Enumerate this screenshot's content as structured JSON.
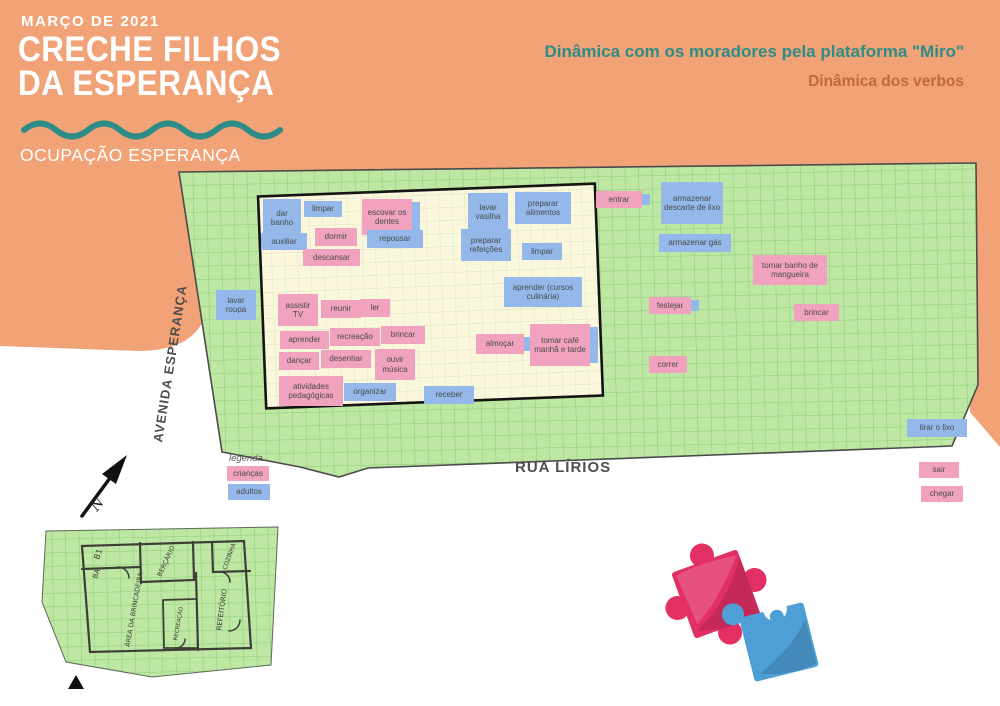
{
  "header": {
    "date": "MARÇO DE 2021",
    "title": "CRECHE FILHOS\nDA ESPERANÇA",
    "subtitle": "OCUPAÇÃO ESPERANÇA"
  },
  "board_titles": {
    "line1": "Dinâmica com os moradores pela plataforma \"Miro\"",
    "line2": "Dinâmica dos verbos"
  },
  "map": {
    "street_left": "AVENIDA ESPERANÇA",
    "street_bottom": "RUA LÍRIOS",
    "north_label": "N",
    "notes": [
      {
        "label": "dar banho",
        "color": "blue",
        "x": 263,
        "y": 199,
        "w": 38,
        "h": 38
      },
      {
        "label": "limpar",
        "color": "blue",
        "x": 304,
        "y": 201,
        "w": 38,
        "h": 16
      },
      {
        "label": "escovar os dentes",
        "color": "pink",
        "x": 362,
        "y": 199,
        "w": 50,
        "h": 36,
        "backing": true
      },
      {
        "label": "auxiliar",
        "color": "blue",
        "x": 261,
        "y": 233,
        "w": 46,
        "h": 17
      },
      {
        "label": "dormir",
        "color": "pink",
        "x": 315,
        "y": 228,
        "w": 42,
        "h": 18
      },
      {
        "label": "repousar",
        "color": "blue",
        "x": 367,
        "y": 230,
        "w": 56,
        "h": 18
      },
      {
        "label": "descansar",
        "color": "pink",
        "x": 303,
        "y": 249,
        "w": 57,
        "h": 17
      },
      {
        "label": "lavar vasilha",
        "color": "blue",
        "x": 468,
        "y": 193,
        "w": 40,
        "h": 38
      },
      {
        "label": "preparar alimentos",
        "color": "blue",
        "x": 515,
        "y": 192,
        "w": 56,
        "h": 32
      },
      {
        "label": "preparar refeições",
        "color": "blue",
        "x": 461,
        "y": 229,
        "w": 50,
        "h": 32
      },
      {
        "label": "limpar",
        "color": "blue",
        "x": 522,
        "y": 243,
        "w": 40,
        "h": 17
      },
      {
        "label": "aprender (cursos culinária)",
        "color": "blue",
        "x": 504,
        "y": 277,
        "w": 78,
        "h": 30
      },
      {
        "label": "assistir TV",
        "color": "pink",
        "x": 278,
        "y": 294,
        "w": 40,
        "h": 32
      },
      {
        "label": "reunir",
        "color": "pink",
        "x": 321,
        "y": 300,
        "w": 40,
        "h": 18
      },
      {
        "label": "ler",
        "color": "pink",
        "x": 360,
        "y": 299,
        "w": 30,
        "h": 18
      },
      {
        "label": "aprender",
        "color": "pink",
        "x": 280,
        "y": 331,
        "w": 49,
        "h": 18
      },
      {
        "label": "recreação",
        "color": "pink",
        "x": 330,
        "y": 328,
        "w": 50,
        "h": 18
      },
      {
        "label": "brincar",
        "color": "pink",
        "x": 381,
        "y": 326,
        "w": 44,
        "h": 18
      },
      {
        "label": "dançar",
        "color": "pink",
        "x": 279,
        "y": 352,
        "w": 40,
        "h": 18
      },
      {
        "label": "desenhar",
        "color": "pink",
        "x": 321,
        "y": 350,
        "w": 50,
        "h": 18
      },
      {
        "label": "ouvir música",
        "color": "pink",
        "x": 375,
        "y": 349,
        "w": 40,
        "h": 31
      },
      {
        "label": "atividades pedagógicas",
        "color": "pink",
        "x": 279,
        "y": 376,
        "w": 64,
        "h": 30
      },
      {
        "label": "organizar",
        "color": "blue",
        "x": 344,
        "y": 383,
        "w": 52,
        "h": 18
      },
      {
        "label": "receber",
        "color": "blue",
        "x": 424,
        "y": 386,
        "w": 50,
        "h": 18
      },
      {
        "label": "almoçar",
        "color": "pink",
        "x": 476,
        "y": 334,
        "w": 48,
        "h": 20,
        "backing": true
      },
      {
        "label": "tomar café manhã e tarde",
        "color": "pink",
        "x": 530,
        "y": 324,
        "w": 60,
        "h": 42,
        "backing": true
      },
      {
        "label": "lavar roupa",
        "color": "blue",
        "x": 216,
        "y": 290,
        "w": 40,
        "h": 30
      },
      {
        "label": "entrar",
        "color": "pink",
        "x": 596,
        "y": 191,
        "w": 46,
        "h": 17,
        "backing": true
      },
      {
        "label": "armazenar descarte de lixo",
        "color": "blue",
        "x": 661,
        "y": 182,
        "w": 62,
        "h": 42
      },
      {
        "label": "armazenar gás",
        "color": "blue",
        "x": 659,
        "y": 234,
        "w": 72,
        "h": 18
      },
      {
        "label": "tomar banho de mangueira",
        "color": "pink",
        "x": 753,
        "y": 255,
        "w": 74,
        "h": 30
      },
      {
        "label": "festejar",
        "color": "pink",
        "x": 649,
        "y": 297,
        "w": 42,
        "h": 17,
        "backing": true
      },
      {
        "label": "brincar",
        "color": "pink",
        "x": 794,
        "y": 304,
        "w": 45,
        "h": 17
      },
      {
        "label": "correr",
        "color": "pink",
        "x": 649,
        "y": 356,
        "w": 38,
        "h": 17
      },
      {
        "label": "tirar o lixo",
        "color": "blue",
        "x": 907,
        "y": 419,
        "w": 60,
        "h": 18
      },
      {
        "label": "sair",
        "color": "pink",
        "x": 919,
        "y": 462,
        "w": 40,
        "h": 16
      },
      {
        "label": "chegar",
        "color": "pink",
        "x": 921,
        "y": 486,
        "w": 42,
        "h": 16
      }
    ]
  },
  "legend": {
    "title": "legenda",
    "items": [
      {
        "label": "crianças",
        "color": "pink"
      },
      {
        "label": "adultos",
        "color": "blue"
      }
    ]
  },
  "floorplan": {
    "rooms": {
      "b1": "B1",
      "ba": "BA",
      "bercario": "BERÇÁRIO",
      "area": "ÁREA DA BRINCADEIRA",
      "recreacao": "RECREAÇÃO",
      "refeitorio": "REFEITÓRIO",
      "cozinha": "COZINHA"
    }
  },
  "colors": {
    "background_orange": "#F1A276",
    "teal": "#2E8C87",
    "accent_text": "#BE6A3F",
    "map_green": "#BDE7A2",
    "map_grid": "#8CCB7A",
    "building_cream": "#FAF7DC",
    "note_pink": "#F0A2BE",
    "note_blue": "#93B8E9",
    "puzzle_pink": "#E23065",
    "puzzle_blue": "#4D9FD6"
  }
}
